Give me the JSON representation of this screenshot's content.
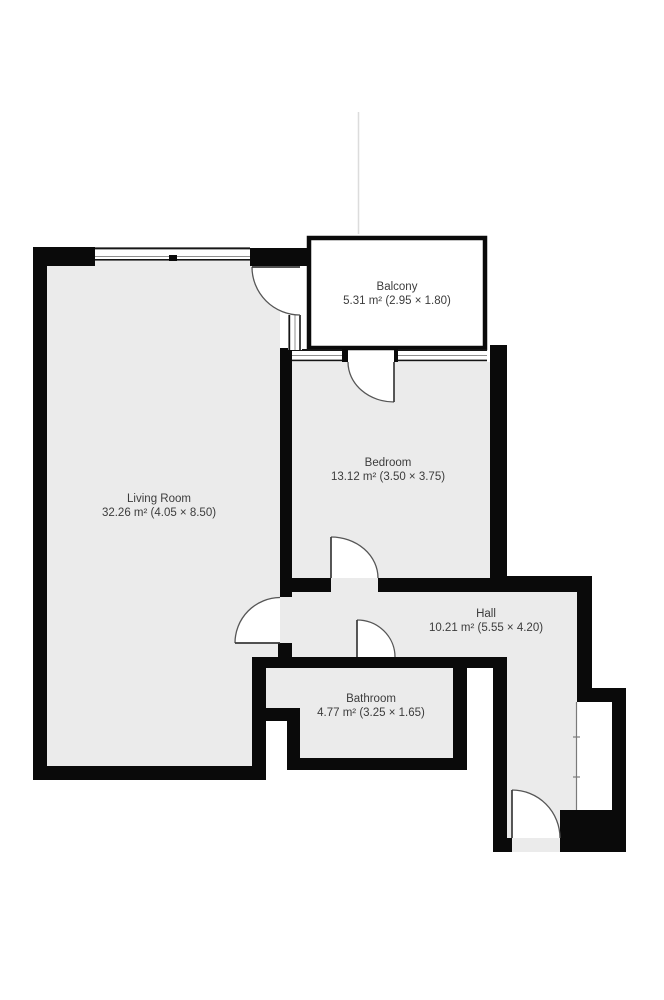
{
  "colors": {
    "wall-color": "#0a0a0a",
    "floor-color": "#ebebeb",
    "label-color": "#3c3c3c"
  },
  "rooms": [
    {
      "name": "Living Room",
      "area": "32.26 m² (4.05 × 8.50)"
    },
    {
      "name": "Bedroom",
      "area": "13.12 m² (3.50 × 3.75)"
    },
    {
      "name": "Hall",
      "area": "10.21 m² (5.55 × 4.20)"
    },
    {
      "name": "Bathroom",
      "area": "4.77 m² (3.25 × 1.65)"
    },
    {
      "name": "Balcony",
      "area": "5.31 m² (2.95 × 1.80)"
    }
  ]
}
